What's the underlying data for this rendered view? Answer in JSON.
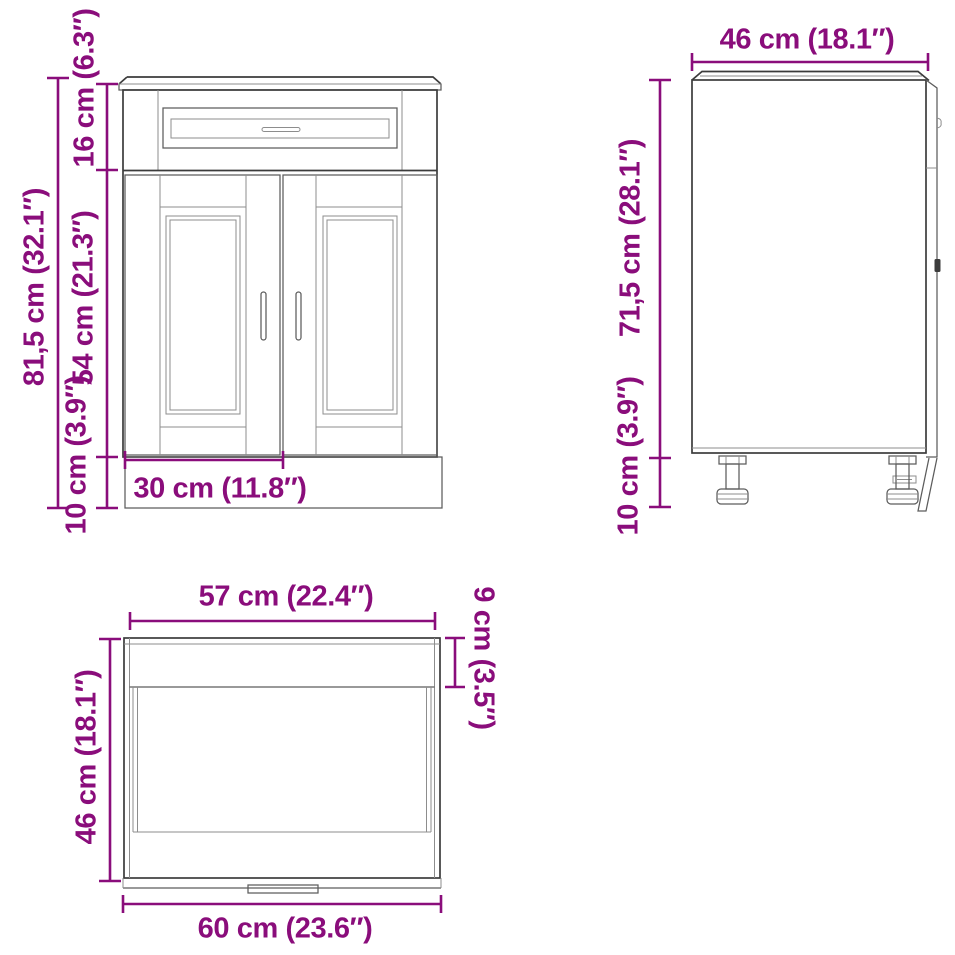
{
  "page": {
    "type": "product dimension diagram",
    "subject": "kitchen base cabinet line drawing with three orthographic views",
    "background_color": "#ffffff",
    "dimension_color": "#8a0d7b",
    "drawing_color": "#3c3c3c"
  },
  "views": {
    "front": {
      "id": "front-view",
      "measurements": {
        "total_height": "81,5 cm (32.1″)",
        "top_section_height": "16 cm (6.3″)",
        "door_section_height": "54 cm (21.3″)",
        "plinth_height": "10 cm (3.9″)",
        "door_width": "30 cm (11.8″)"
      }
    },
    "side": {
      "id": "side-view",
      "measurements": {
        "depth": "46 cm (18.1″)",
        "body_height": "71,5 cm (28.1″)",
        "plinth_height": "10 cm (3.9″)"
      }
    },
    "top": {
      "id": "top-view",
      "measurements": {
        "top_panel_width": "57 cm (22.4″)",
        "front_edge_depth": "9 cm (3.5″)",
        "depth": "46 cm (18.1″)",
        "total_width": "60 cm (23.6″)"
      }
    }
  }
}
